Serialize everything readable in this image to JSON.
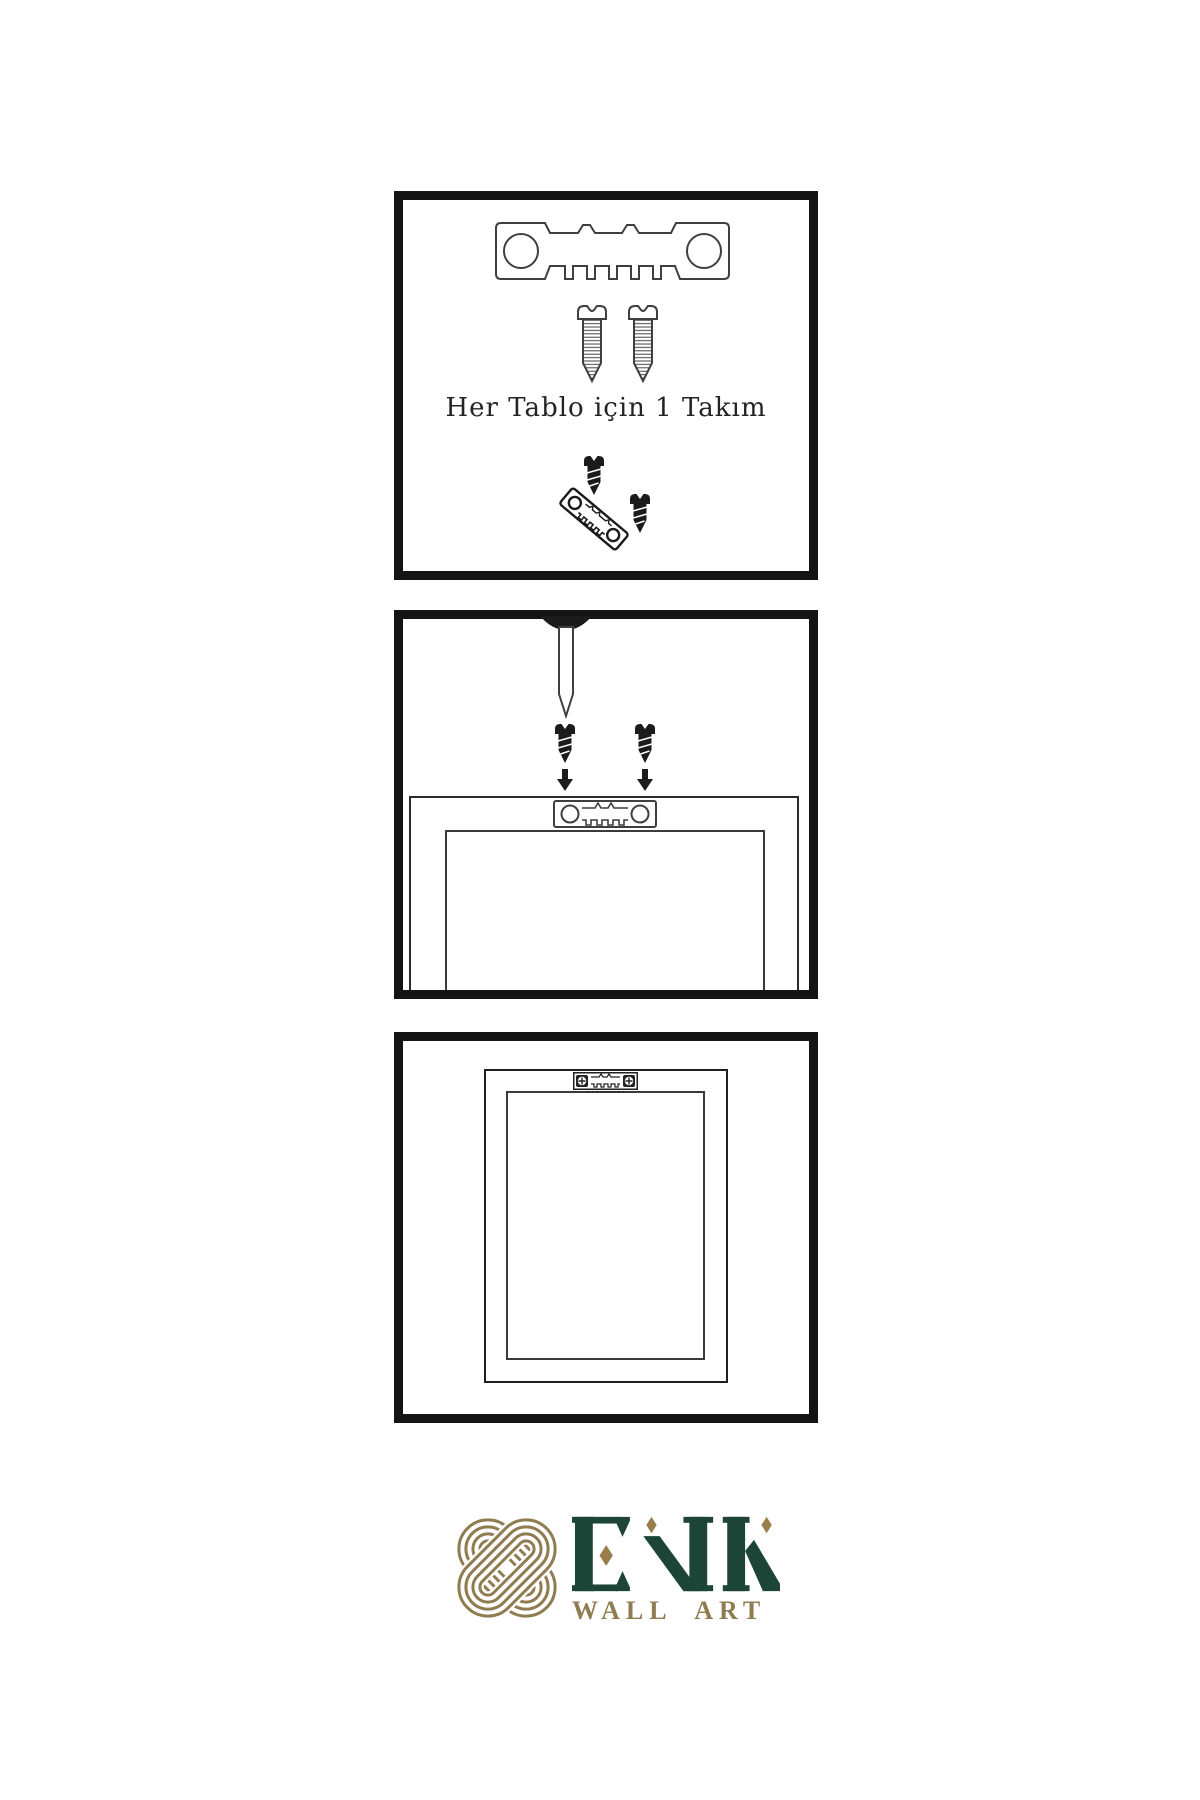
{
  "colors": {
    "panel_border": "#141414",
    "line": "#3f3f3f",
    "dark_fill": "#1b1b1b",
    "text": "#242424",
    "logo_gold": "#8f7c50",
    "logo_green": "#1c4538",
    "diamond_gold": "#9b7d4a",
    "background": "#ffffff"
  },
  "panels": [
    {
      "name": "hardware-kit",
      "caption": "Her Tablo için 1 Takım",
      "items": [
        "sawtooth-hanger-plate",
        "mounting-screw",
        "mounting-screw",
        "dark-screw",
        "tilted-sawtooth-hanger",
        "dark-screw"
      ]
    },
    {
      "name": "attach-hanger-to-frame-back",
      "items": [
        "wall-nail",
        "dark-screw",
        "dark-screw",
        "down-arrow",
        "down-arrow",
        "sawtooth-hanger-plate",
        "frame-back-outer",
        "frame-back-inner"
      ]
    },
    {
      "name": "frame-with-hanger-mounted",
      "items": [
        "frame-back-outer",
        "frame-back-inner",
        "mounted-sawtooth-hanger-with-screws"
      ]
    }
  ],
  "logo": {
    "name": "ENK",
    "subtitle": "WALL ART",
    "emblem": "interlocking-knot"
  }
}
